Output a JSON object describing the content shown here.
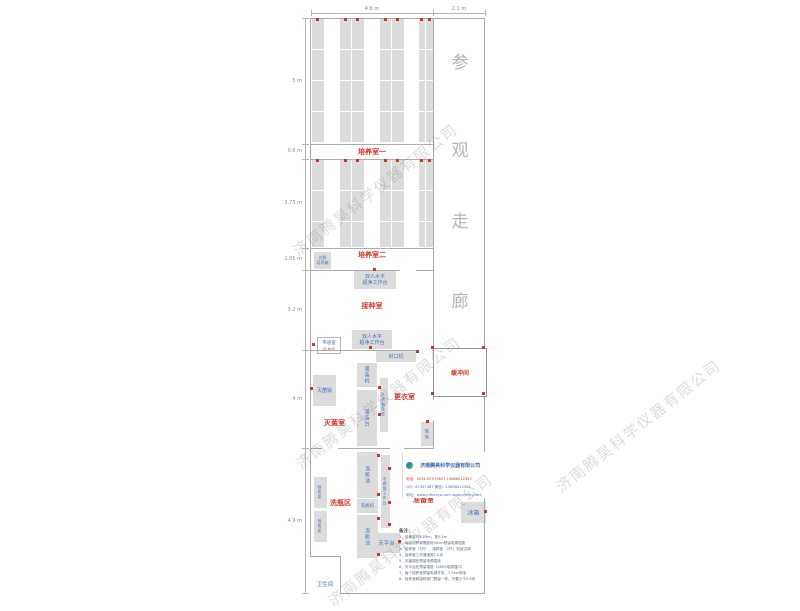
{
  "watermark": {
    "text": "济南腾昊科学仪器有限公司",
    "color": "#c4c4c4"
  },
  "corridor": {
    "label": "参观走廊",
    "chars": [
      "参",
      "观",
      "走",
      "廊"
    ]
  },
  "dimensions": {
    "top": [
      "4.8 m",
      "2.1 m"
    ],
    "left": [
      "5 m",
      "0.6 m",
      "3.75 m",
      "1.05 m",
      "3.2 m",
      "4 m",
      "4.9 m"
    ]
  },
  "rooms": {
    "culture1": "培养室一",
    "culture2": "培养室二",
    "inoculation": "接种室",
    "sterilization": "灭菌室",
    "changing": "更衣室",
    "buffer": "缓冲间",
    "washing_area": "洗瓶区",
    "prep": "准备室",
    "toilet": "卫生间"
  },
  "equipment": {
    "light_incubator_line1": "光照",
    "light_incubator_line2": "培养箱",
    "clean_bench_line1": "双人水平",
    "clean_bench_line2": "超净工作台",
    "pass_window": "传递窗",
    "pass_window_area": "(0.6㎡)",
    "sealing_machine": "封口机",
    "autoclave": "灭菌锅",
    "filling_machine": "灌装机",
    "steel_bench": "不锈钢条凳",
    "filling_table": "灌装台",
    "shoe_rack": "鞋架",
    "soak_pool": "泡瓶池",
    "steel_worktable": "不锈钢工作台",
    "bottle_washer": "洗瓶机",
    "bottle_rack": "晾瓶架",
    "balance_table": "天平台",
    "fridge": "冰箱"
  },
  "company": {
    "name": "济南腾昊科学仪器有限公司",
    "phone": "电话：0531-87919827  15866012352",
    "qq": "QQ：87437487  微信：15866012352",
    "web": "网址：www.jnthkxyq.com  www.cnthky.com"
  },
  "notes": {
    "title": "备注：",
    "items": [
      "1、培养架长1.25m，宽0.5m",
      "2、每组培养架需距地30cm预留电源插座",
      "3、培养室（3只）、接种室（2只）安装空调",
      "4、接种室工作通道宽1.0米",
      "5、灭菌锅处预留电源插座",
      "6、天平台处预留插座（380V电源插口）",
      "7、每个培养室预留电源开关，7.5kw用电",
      "8、培养室和接种室门预留一样，不要小于0.9米"
    ]
  },
  "colors": {
    "label_red": "#d2382e",
    "label_blue": "#4a72b8",
    "wall_gray": "#adadad",
    "rack_fill": "#dcdcdc",
    "corridor_text": "#b4b4b4"
  }
}
